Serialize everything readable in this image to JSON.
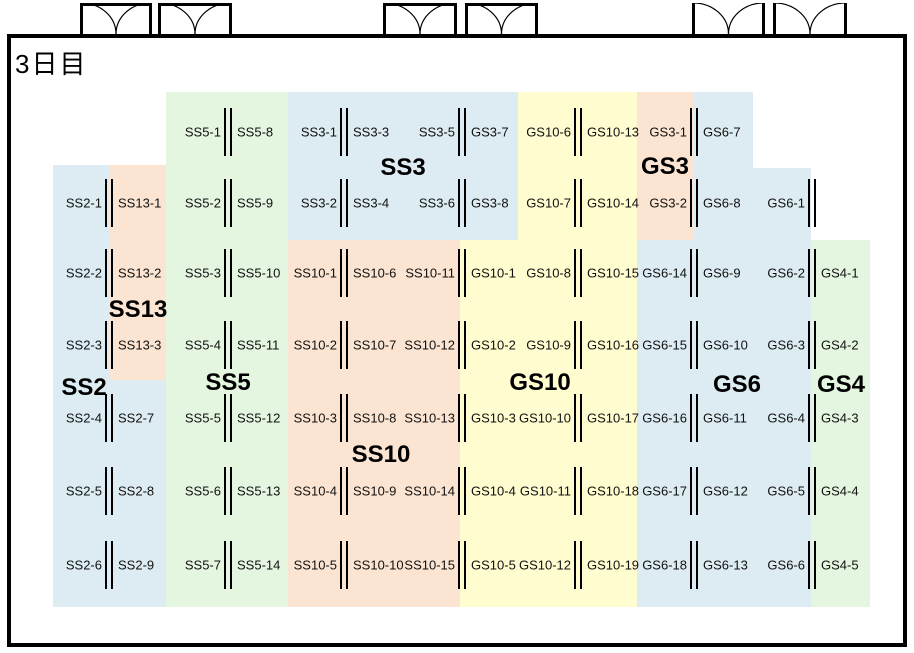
{
  "title": "3日目",
  "colors": {
    "blue": "#DCECF2",
    "peach": "#FBE5D2",
    "green": "#E4F5E0",
    "yellow": "#FFFCCF",
    "line": "#000000"
  },
  "room": {
    "x": 7,
    "y": 34,
    "w": 900,
    "h": 613
  },
  "doors": [
    {
      "x": 80,
      "w": 72,
      "frame_top": true
    },
    {
      "x": 158,
      "w": 74,
      "frame_top": true
    },
    {
      "x": 383,
      "w": 74,
      "frame_top": true
    },
    {
      "x": 465,
      "w": 73,
      "frame_top": true
    },
    {
      "x": 692,
      "w": 73,
      "frame_top": false
    },
    {
      "x": 773,
      "w": 74,
      "frame_top": false
    }
  ],
  "zones": [
    {
      "name": "ss2",
      "color": "blue",
      "x": 53,
      "y": 165,
      "w": 113,
      "h": 442
    },
    {
      "name": "ss13",
      "color": "peach",
      "x": 109,
      "y": 165,
      "w": 57,
      "h": 215
    },
    {
      "name": "ss5",
      "color": "green",
      "x": 166,
      "y": 92,
      "w": 122,
      "h": 515
    },
    {
      "name": "ss3",
      "color": "blue",
      "x": 288,
      "y": 92,
      "w": 230,
      "h": 148
    },
    {
      "name": "ss10",
      "color": "peach",
      "x": 288,
      "y": 240,
      "w": 172,
      "h": 367
    },
    {
      "name": "gs10-top",
      "color": "yellow",
      "x": 518,
      "y": 92,
      "w": 119,
      "h": 148
    },
    {
      "name": "gs10",
      "color": "yellow",
      "x": 460,
      "y": 240,
      "w": 177,
      "h": 367
    },
    {
      "name": "gs3",
      "color": "peach",
      "x": 637,
      "y": 92,
      "w": 56,
      "h": 148
    },
    {
      "name": "gs6-top1",
      "color": "blue",
      "x": 693,
      "y": 92,
      "w": 60,
      "h": 76
    },
    {
      "name": "gs6-top2",
      "color": "blue",
      "x": 693,
      "y": 168,
      "w": 118,
      "h": 72
    },
    {
      "name": "gs6",
      "color": "blue",
      "x": 637,
      "y": 240,
      "w": 174,
      "h": 367
    },
    {
      "name": "gs4",
      "color": "green",
      "x": 811,
      "y": 240,
      "w": 59,
      "h": 367
    }
  ],
  "group_labels": [
    {
      "text": "SS3",
      "x": 403,
      "y": 168
    },
    {
      "text": "GS3",
      "x": 665,
      "y": 167
    },
    {
      "text": "SS13",
      "x": 138,
      "y": 310
    },
    {
      "text": "SS2",
      "x": 84,
      "y": 388
    },
    {
      "text": "SS5",
      "x": 228,
      "y": 383
    },
    {
      "text": "GS10",
      "x": 540,
      "y": 383
    },
    {
      "text": "SS10",
      "x": 381,
      "y": 455
    },
    {
      "text": "GS6",
      "x": 737,
      "y": 385
    },
    {
      "text": "GS4",
      "x": 841,
      "y": 385
    }
  ],
  "wall_rows": [
    {
      "y": 132,
      "xs": [
        228,
        344,
        462,
        578,
        694
      ]
    },
    {
      "y": 203,
      "xs": [
        109,
        228,
        344,
        462,
        578,
        694,
        812
      ]
    },
    {
      "y": 273,
      "xs": [
        109,
        228,
        344,
        462,
        578,
        694,
        812
      ]
    },
    {
      "y": 345,
      "xs": [
        109,
        228,
        344,
        462,
        578,
        694,
        812
      ]
    },
    {
      "y": 418,
      "xs": [
        109,
        228,
        344,
        462,
        578,
        694,
        812
      ]
    },
    {
      "y": 491,
      "xs": [
        109,
        228,
        344,
        462,
        578,
        694,
        812
      ]
    },
    {
      "y": 565,
      "xs": [
        109,
        228,
        344,
        462,
        578,
        694,
        812
      ]
    }
  ],
  "booth_rows": [
    {
      "y": 132,
      "items": [
        [
          "SS5-1",
          "R",
          228
        ],
        [
          "SS5-8",
          "L",
          228
        ],
        [
          "SS3-1",
          "R",
          344
        ],
        [
          "SS3-3",
          "L",
          344
        ],
        [
          "SS3-5",
          "R",
          462
        ],
        [
          "GS3-7",
          "L",
          462
        ],
        [
          "GS10-6",
          "R",
          578
        ],
        [
          "GS10-13",
          "L",
          578
        ],
        [
          "GS3-1",
          "R",
          694
        ],
        [
          "GS6-7",
          "L",
          694
        ]
      ]
    },
    {
      "y": 203,
      "items": [
        [
          "SS2-1",
          "R",
          109
        ],
        [
          "SS13-1",
          "L",
          109
        ],
        [
          "SS5-2",
          "R",
          228
        ],
        [
          "SS5-9",
          "L",
          228
        ],
        [
          "SS3-2",
          "R",
          344
        ],
        [
          "SS3-4",
          "L",
          344
        ],
        [
          "SS3-6",
          "R",
          462
        ],
        [
          "GS3-8",
          "L",
          462
        ],
        [
          "GS10-7",
          "R",
          578
        ],
        [
          "GS10-14",
          "L",
          578
        ],
        [
          "GS3-2",
          "R",
          694
        ],
        [
          "GS6-8",
          "L",
          694
        ],
        [
          "GS6-1",
          "R",
          812
        ]
      ]
    },
    {
      "y": 273,
      "items": [
        [
          "SS2-2",
          "R",
          109
        ],
        [
          "SS13-2",
          "L",
          109
        ],
        [
          "SS5-3",
          "R",
          228
        ],
        [
          "SS5-10",
          "L",
          228
        ],
        [
          "SS10-1",
          "R",
          344
        ],
        [
          "SS10-6",
          "L",
          344
        ],
        [
          "SS10-11",
          "R",
          462
        ],
        [
          "GS10-1",
          "L",
          462
        ],
        [
          "GS10-8",
          "R",
          578
        ],
        [
          "GS10-15",
          "L",
          578
        ],
        [
          "GS6-14",
          "R",
          694
        ],
        [
          "GS6-9",
          "L",
          694
        ],
        [
          "GS6-2",
          "R",
          812
        ],
        [
          "GS4-1",
          "L",
          812
        ]
      ]
    },
    {
      "y": 345,
      "items": [
        [
          "SS2-3",
          "R",
          109
        ],
        [
          "SS13-3",
          "L",
          109
        ],
        [
          "SS5-4",
          "R",
          228
        ],
        [
          "SS5-11",
          "L",
          228
        ],
        [
          "SS10-2",
          "R",
          344
        ],
        [
          "SS10-7",
          "L",
          344
        ],
        [
          "SS10-12",
          "R",
          462
        ],
        [
          "GS10-2",
          "L",
          462
        ],
        [
          "GS10-9",
          "R",
          578
        ],
        [
          "GS10-16",
          "L",
          578
        ],
        [
          "GS6-15",
          "R",
          694
        ],
        [
          "GS6-10",
          "L",
          694
        ],
        [
          "GS6-3",
          "R",
          812
        ],
        [
          "GS4-2",
          "L",
          812
        ]
      ]
    },
    {
      "y": 418,
      "items": [
        [
          "SS2-4",
          "R",
          109
        ],
        [
          "SS2-7",
          "L",
          109
        ],
        [
          "SS5-5",
          "R",
          228
        ],
        [
          "SS5-12",
          "L",
          228
        ],
        [
          "SS10-3",
          "R",
          344
        ],
        [
          "SS10-8",
          "L",
          344
        ],
        [
          "SS10-13",
          "R",
          462
        ],
        [
          "GS10-3",
          "L",
          462
        ],
        [
          "GS10-10",
          "R",
          578
        ],
        [
          "GS10-17",
          "L",
          578
        ],
        [
          "GS6-16",
          "R",
          694
        ],
        [
          "GS6-11",
          "L",
          694
        ],
        [
          "GS6-4",
          "R",
          812
        ],
        [
          "GS4-3",
          "L",
          812
        ]
      ]
    },
    {
      "y": 491,
      "items": [
        [
          "SS2-5",
          "R",
          109
        ],
        [
          "SS2-8",
          "L",
          109
        ],
        [
          "SS5-6",
          "R",
          228
        ],
        [
          "SS5-13",
          "L",
          228
        ],
        [
          "SS10-4",
          "R",
          344
        ],
        [
          "SS10-9",
          "L",
          344
        ],
        [
          "SS10-14",
          "R",
          462
        ],
        [
          "GS10-4",
          "L",
          462
        ],
        [
          "GS10-11",
          "R",
          578
        ],
        [
          "GS10-18",
          "L",
          578
        ],
        [
          "GS6-17",
          "R",
          694
        ],
        [
          "GS6-12",
          "L",
          694
        ],
        [
          "GS6-5",
          "R",
          812
        ],
        [
          "GS4-4",
          "L",
          812
        ]
      ]
    },
    {
      "y": 565,
      "items": [
        [
          "SS2-6",
          "R",
          109
        ],
        [
          "SS2-9",
          "L",
          109
        ],
        [
          "SS5-7",
          "R",
          228
        ],
        [
          "SS5-14",
          "L",
          228
        ],
        [
          "SS10-5",
          "R",
          344
        ],
        [
          "SS10-10",
          "L",
          344
        ],
        [
          "SS10-15",
          "R",
          462
        ],
        [
          "GS10-5",
          "L",
          462
        ],
        [
          "GS10-12",
          "R",
          578
        ],
        [
          "GS10-19",
          "L",
          578
        ],
        [
          "GS6-18",
          "R",
          694
        ],
        [
          "GS6-13",
          "L",
          694
        ],
        [
          "GS6-6",
          "R",
          812
        ],
        [
          "GS4-5",
          "L",
          812
        ]
      ]
    }
  ]
}
